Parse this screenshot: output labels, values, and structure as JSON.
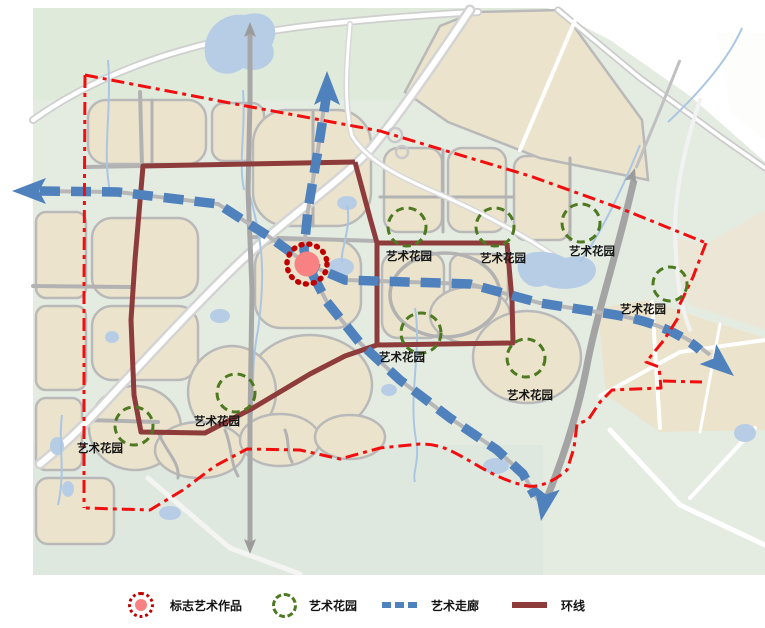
{
  "map": {
    "colors": {
      "corridor": "#4f81bd",
      "ring": "#8d3b3b",
      "boundary": "#f10e0e",
      "garden": "#4d7a20",
      "landmark_ring": "#c00000",
      "landmark_fill": "#f88181"
    },
    "landmark": {
      "cx": 307,
      "cy": 264
    },
    "gardens": [
      {
        "text": "艺术花园",
        "cx": 407,
        "cy": 227,
        "r": 19,
        "lx": 386,
        "ly": 260
      },
      {
        "text": "艺术花园",
        "cx": 495,
        "cy": 227,
        "r": 19,
        "lx": 480,
        "ly": 262
      },
      {
        "text": "艺术花园",
        "cx": 581,
        "cy": 223,
        "r": 19,
        "lx": 569,
        "ly": 255
      },
      {
        "text": "艺术花园",
        "cx": 670,
        "cy": 284,
        "r": 17,
        "lx": 620,
        "ly": 313
      },
      {
        "text": "艺术花园",
        "cx": 421,
        "cy": 333,
        "r": 20,
        "lx": 379,
        "ly": 361
      },
      {
        "text": "艺术花园",
        "cx": 526,
        "cy": 358,
        "r": 19,
        "lx": 507,
        "ly": 399
      },
      {
        "text": "艺术花园",
        "cx": 236,
        "cy": 393,
        "r": 19,
        "lx": 194,
        "ly": 425
      },
      {
        "text": "艺术花园",
        "cx": 134,
        "cy": 426,
        "r": 19,
        "lx": 77,
        "ly": 452
      }
    ]
  },
  "legend": {
    "items": [
      {
        "id": "landmark",
        "label": "标志艺术作品"
      },
      {
        "id": "garden",
        "label": "艺术花园"
      },
      {
        "id": "corridor",
        "label": "艺术走廊"
      },
      {
        "id": "ring",
        "label": "环线"
      }
    ]
  }
}
